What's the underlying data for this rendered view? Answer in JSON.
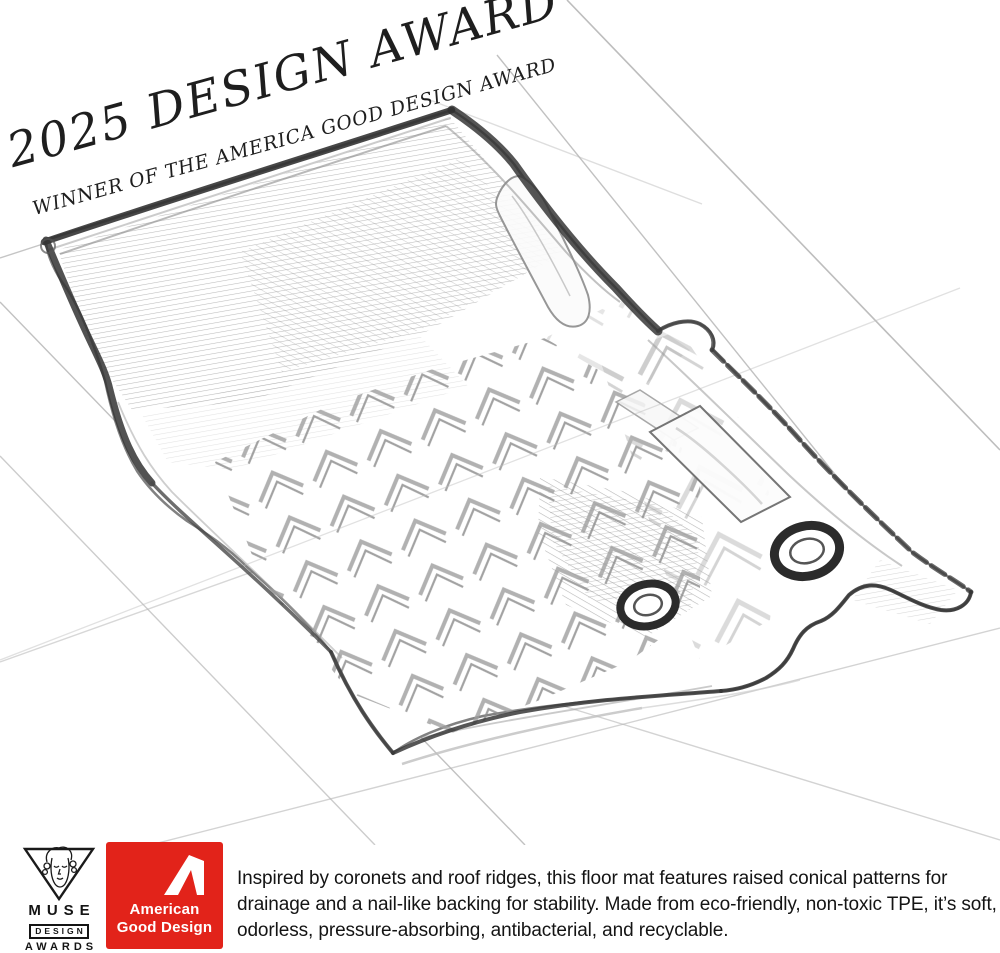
{
  "award_banner": {
    "line1": "2025 DESIGN AWARD",
    "line2": "WINNER OF THE AMERICA GOOD DESIGN AWARD"
  },
  "illustration": {
    "subject": "pencil sketch of a car floor mat with raised chevron ridge pattern, two grommet holes and perspective guide lines"
  },
  "muse_badge": {
    "line1": "MUSE",
    "line2": "DESIGN",
    "line3": "AWARDS"
  },
  "good_design_badge": {
    "line1": "American",
    "line2": "Good Design",
    "background_color": "#e2231a",
    "text_color": "#ffffff"
  },
  "description_text": "Inspired by coronets and roof ridges, this floor mat features raised conical patterns for drainage and a nail-like backing for stability. Made from eco-friendly, non-toxic TPE, it’s soft, odorless, pressure-absorbing, antibacterial, and recyclable."
}
